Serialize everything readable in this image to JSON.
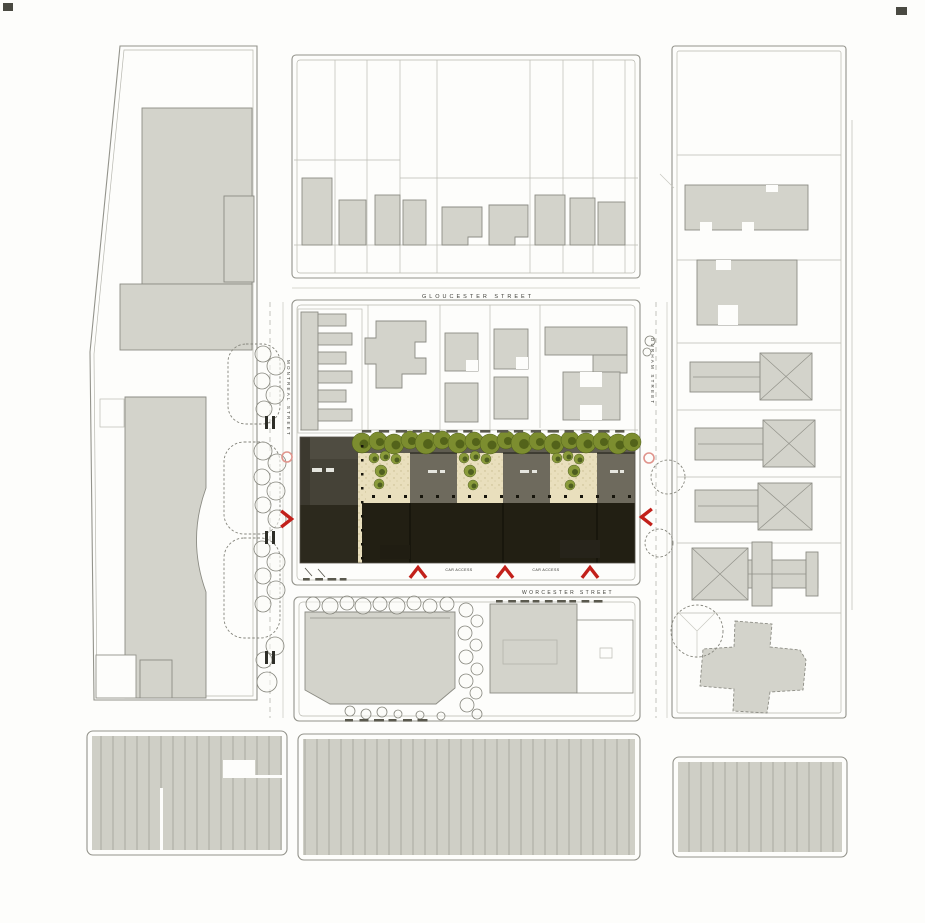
{
  "title": "Urban block site plan",
  "colors": {
    "paper": "#fdfdfb",
    "line": "#93938b",
    "line_light": "#b8b8b0",
    "building_fill": "#d3d3cb",
    "building_stroke": "#8c8c84",
    "roof_gray": "#6e6a5d",
    "dark_block": "#4f4c41",
    "site_black": "#221f13",
    "courtyard": "#e9dfbd",
    "canopy": "#7c8d2f",
    "canopy_dark": "#4c5c16",
    "tree": "#8a9b3a",
    "tree_dark": "#3f4f1a",
    "accent_red": "#c2201a",
    "accent_pink": "#e0948c"
  },
  "streets": {
    "top": "GLOUCESTER STREET",
    "bottom": "WORCESTER STREET",
    "left": "MONTREAL STREET",
    "right": "DURHAM STREET"
  },
  "annotations": {
    "access_left": "CAR ACCESS",
    "access_right": "CAR ACCESS"
  },
  "render": {
    "canopy": [
      [
        362,
        443,
        10
      ],
      [
        378,
        441,
        9
      ],
      [
        394,
        444,
        10
      ],
      [
        410,
        440,
        9
      ],
      [
        426,
        443,
        11
      ],
      [
        442,
        440,
        9
      ],
      [
        458,
        443,
        10
      ],
      [
        474,
        441,
        9
      ],
      [
        490,
        444,
        10
      ],
      [
        506,
        440,
        9
      ],
      [
        522,
        443,
        11
      ],
      [
        538,
        441,
        9
      ],
      [
        554,
        444,
        10
      ],
      [
        570,
        440,
        9
      ],
      [
        586,
        443,
        10
      ],
      [
        602,
        441,
        9
      ],
      [
        618,
        444,
        10
      ],
      [
        632,
        442,
        9
      ]
    ],
    "courtyard_trees": [
      [
        374,
        458,
        5
      ],
      [
        385,
        456,
        5
      ],
      [
        396,
        459,
        5
      ],
      [
        381,
        471,
        6
      ],
      [
        379,
        484,
        5
      ],
      [
        464,
        458,
        5
      ],
      [
        475,
        456,
        5
      ],
      [
        486,
        459,
        5
      ],
      [
        470,
        471,
        6
      ],
      [
        473,
        485,
        5
      ],
      [
        557,
        458,
        5
      ],
      [
        568,
        456,
        5
      ],
      [
        579,
        459,
        5
      ],
      [
        574,
        471,
        6
      ],
      [
        570,
        485,
        5
      ]
    ],
    "street_trees": [
      [
        263,
        354,
        8
      ],
      [
        276,
        366,
        9
      ],
      [
        262,
        381,
        8
      ],
      [
        275,
        395,
        9
      ],
      [
        264,
        409,
        8
      ],
      [
        263,
        451,
        9
      ],
      [
        277,
        463,
        9
      ],
      [
        262,
        477,
        8
      ],
      [
        276,
        491,
        9
      ],
      [
        263,
        505,
        8
      ],
      [
        277,
        519,
        9
      ],
      [
        262,
        549,
        8
      ],
      [
        276,
        562,
        9
      ],
      [
        263,
        576,
        8
      ],
      [
        276,
        590,
        9
      ],
      [
        263,
        604,
        8
      ],
      [
        275,
        646,
        9
      ],
      [
        264,
        660,
        8
      ],
      [
        267,
        682,
        10
      ],
      [
        650,
        341,
        5
      ],
      [
        647,
        352,
        4
      ],
      [
        313,
        604,
        7
      ],
      [
        330,
        606,
        8
      ],
      [
        347,
        603,
        7
      ],
      [
        363,
        606,
        8
      ],
      [
        380,
        604,
        7
      ],
      [
        397,
        606,
        8
      ],
      [
        414,
        603,
        7
      ],
      [
        430,
        606,
        7
      ],
      [
        447,
        604,
        7
      ],
      [
        466,
        610,
        7
      ],
      [
        477,
        621,
        6
      ],
      [
        465,
        633,
        7
      ],
      [
        476,
        645,
        6
      ],
      [
        466,
        657,
        7
      ],
      [
        477,
        669,
        6
      ],
      [
        466,
        681,
        7
      ],
      [
        476,
        693,
        6
      ],
      [
        467,
        705,
        7
      ],
      [
        477,
        714,
        5
      ],
      [
        350,
        711,
        5
      ],
      [
        366,
        714,
        5
      ],
      [
        382,
        712,
        5
      ],
      [
        398,
        714,
        4
      ],
      [
        420,
        715,
        4
      ],
      [
        441,
        716,
        4
      ]
    ],
    "dashed_trees": [
      [
        668,
        477,
        17
      ],
      [
        659,
        543,
        14
      ],
      [
        697,
        631,
        26
      ]
    ],
    "chevrons": [
      [
        287,
        519,
        0
      ],
      [
        646,
        517,
        180
      ],
      [
        418,
        572,
        -90
      ],
      [
        505,
        572,
        -90
      ],
      [
        590,
        572,
        -90
      ]
    ],
    "crossing_bars": [
      [
        265,
        416
      ],
      [
        265,
        531
      ],
      [
        265,
        651
      ]
    ],
    "walk_dots": {
      "y": 495,
      "x0": 372,
      "x1": 630,
      "step": 16
    },
    "strip_dots": {
      "x": 361,
      "y0": 445,
      "y1": 557,
      "step": 14
    },
    "smudges": [
      {
        "x0": 362,
        "x1": 632,
        "y": 430,
        "n": 16
      },
      {
        "x0": 496,
        "x1": 606,
        "y": 600,
        "n": 9
      },
      {
        "x0": 303,
        "x1": 352,
        "y": 578,
        "n": 4
      },
      {
        "x0": 345,
        "x1": 432,
        "y": 719,
        "n": 6
      }
    ],
    "pink_markers": [
      [
        287,
        457
      ],
      [
        649,
        458
      ]
    ]
  }
}
